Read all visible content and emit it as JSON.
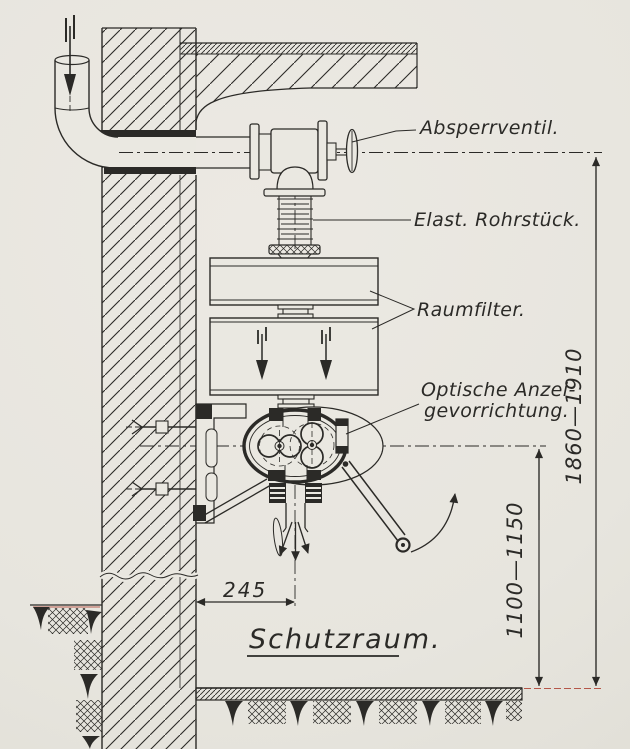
{
  "callouts": {
    "absperrventil": "Absperrventil.",
    "elast_rohrstueck": "Elast. Rohrstück.",
    "raumfilter": "Raumfilter.",
    "optische_anzeige_line1": "Optische Anzei-",
    "optische_anzeige_line2": "gevorrichtung."
  },
  "dimensions": {
    "floor_to_pipe_axis": "1860—1910",
    "floor_to_blower_axis": "1100—1150",
    "wall_to_axis": "245"
  },
  "room": {
    "label": "Schutzraum."
  },
  "colors": {
    "paper": "#eae8e1",
    "ink": "#2b2a27",
    "scan_red": "#b0483a"
  }
}
